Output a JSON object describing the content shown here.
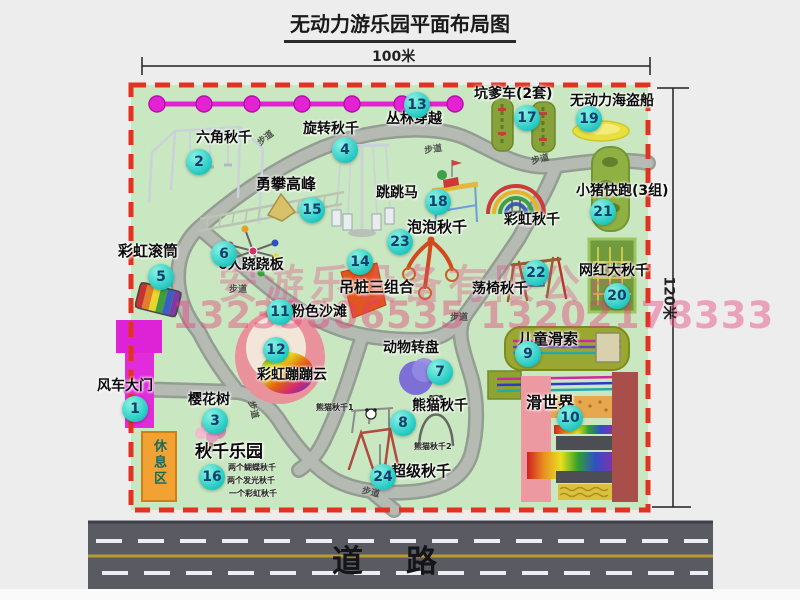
{
  "title": "无动力游乐园平面布局图",
  "dim": {
    "w": "100米",
    "h": "120米"
  },
  "road": {
    "label": "道　路"
  },
  "rest_area_label": "休息区",
  "walkway_label": "步道",
  "watermark": {
    "company": "安游乐设备有限公司",
    "phone": "13233806535 13202178333"
  },
  "extra": {
    "rainbow_swing": "彩虹秋千"
  },
  "swing_details": [
    "两个蝴蝶秋千",
    "两个发光秋千",
    "一个彩虹秋千"
  ],
  "panda_subs": [
    "熊猫秋千1",
    "熊猫秋千2"
  ],
  "attractions": [
    {
      "num": "1",
      "label": "风车大门"
    },
    {
      "num": "2",
      "label": "六角秋千"
    },
    {
      "num": "3",
      "label": "樱花树"
    },
    {
      "num": "4",
      "label": "旋转秋千"
    },
    {
      "num": "5",
      "label": "彩虹滚筒"
    },
    {
      "num": "6",
      "label": "6人跷跷板"
    },
    {
      "num": "7",
      "label": "动物转盘"
    },
    {
      "num": "8",
      "label": "熊猫秋千"
    },
    {
      "num": "9",
      "label": "儿童滑索"
    },
    {
      "num": "10",
      "label": "滑世界"
    },
    {
      "num": "11",
      "label": "粉色沙滩"
    },
    {
      "num": "12",
      "label": "彩虹蹦蹦云"
    },
    {
      "num": "13",
      "label": "丛林穿越"
    },
    {
      "num": "14",
      "label": "吊桩三组合"
    },
    {
      "num": "15",
      "label": "勇攀高峰"
    },
    {
      "num": "16",
      "label": "秋千乐园"
    },
    {
      "num": "17",
      "label": "坑爹车(2套)"
    },
    {
      "num": "18",
      "label": "跳跳马"
    },
    {
      "num": "19",
      "label": "无动力海盗船"
    },
    {
      "num": "20",
      "label": "网红大秋千"
    },
    {
      "num": "21",
      "label": "小猪快跑(3组)"
    },
    {
      "num": "22",
      "label": "荡椅秋千"
    },
    {
      "num": "23",
      "label": "泡泡秋千"
    },
    {
      "num": "24",
      "label": "超级秋千"
    }
  ]
}
